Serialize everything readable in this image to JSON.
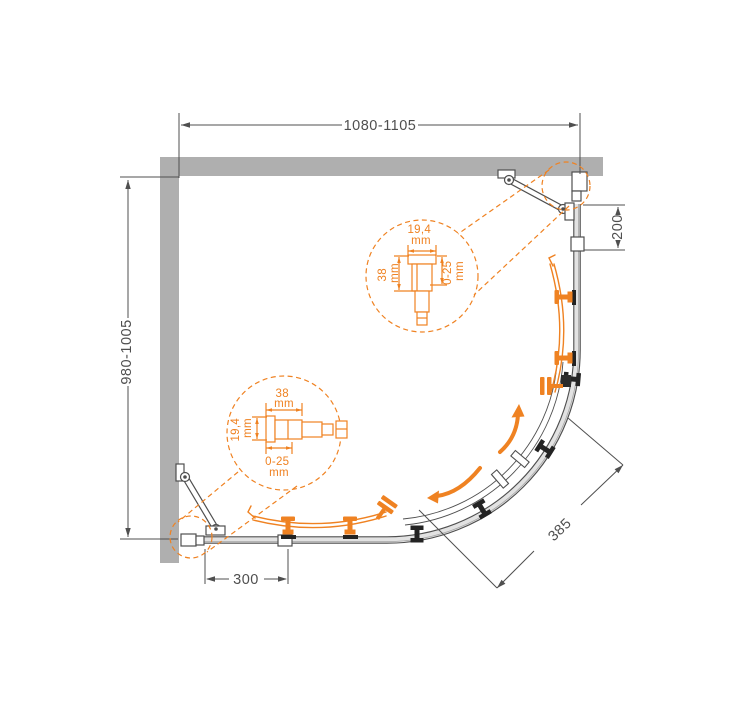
{
  "drawing": {
    "dimensions": {
      "width_top": "1080-1105",
      "depth_left": "980-1005",
      "fixed_right": "200",
      "fixed_bottom": "300",
      "opening_curve": "385"
    },
    "detail_top": {
      "width": "19,4",
      "width_unit": "mm",
      "depth": "38",
      "depth_unit": "mm",
      "adjust": "0-25",
      "adjust_unit": "mm"
    },
    "detail_bottom": {
      "width": "38",
      "width_unit": "mm",
      "depth": "19,4",
      "depth_unit": "mm",
      "adjust": "0-25",
      "adjust_unit": "mm"
    },
    "colors": {
      "accent_orange": "#EF8222",
      "wall_gray": "#AFAFAF",
      "line_gray": "#4F4F4F",
      "roller_black": "#232323"
    }
  }
}
